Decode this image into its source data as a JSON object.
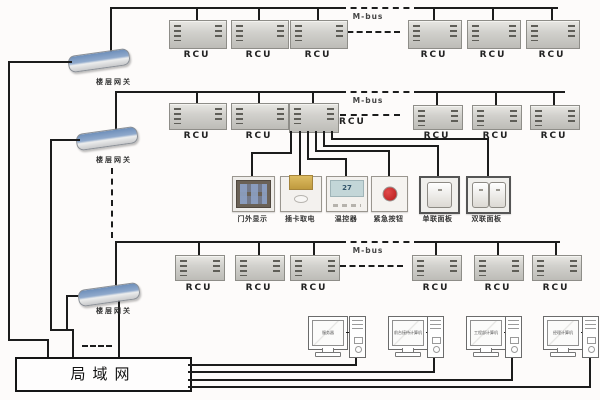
{
  "colors": {
    "wire": "#1c1c1c",
    "rcu_body": "#d2d1cd",
    "gateway_blue": "#6e8fba",
    "lcd_green": "#c3d6d8",
    "emergency_red": "#b51a1a",
    "card_gold": "#c8a449"
  },
  "floors": [
    {
      "gateway": "楼层网关",
      "bus": "M-bus",
      "rcus": [
        "RCU",
        "RCU",
        "RCU",
        "RCU",
        "RCU",
        "RCU"
      ]
    },
    {
      "gateway": "楼层网关",
      "bus": "M-bus",
      "rcus": [
        "RCU",
        "RCU",
        "RCU",
        "RCU",
        "RCU",
        "RCU"
      ]
    },
    {
      "gateway": "楼层网关",
      "bus": "M-bus",
      "rcus": [
        "RCU",
        "RCU",
        "RCU",
        "RCU",
        "RCU",
        "RCU"
      ]
    }
  ],
  "room_devices": [
    {
      "label": "门外显示"
    },
    {
      "label": "插卡取电"
    },
    {
      "label": "温控器",
      "reading": "27"
    },
    {
      "label": "紧急按钮"
    },
    {
      "label": "单联面板"
    },
    {
      "label": "双联面板"
    }
  ],
  "lan": {
    "label": "局域网"
  },
  "computers": [
    {
      "screen": "服务器"
    },
    {
      "screen": "前台接待计算机"
    },
    {
      "screen": "工程部计算机"
    },
    {
      "screen": "经理计算机"
    }
  ]
}
